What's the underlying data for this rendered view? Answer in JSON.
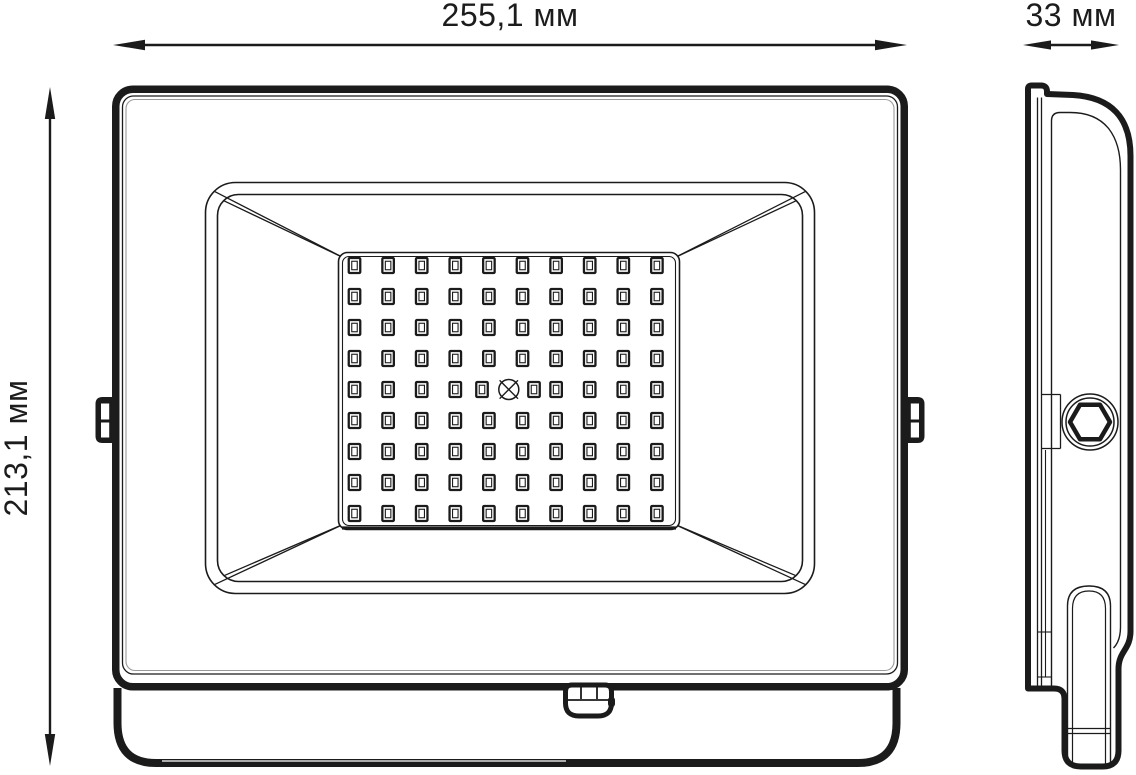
{
  "page": {
    "background": "#ffffff"
  },
  "drawing": {
    "type": "technical-dimension-drawing",
    "subject": "LED floodlight — front view and side view",
    "colors": {
      "line": "#1b1b1b",
      "highlight": "#9a9a9a",
      "background": "#ffffff"
    },
    "dimensions": {
      "width": {
        "label": "255,1 мм",
        "value_mm": 255.1,
        "orientation": "horizontal-top"
      },
      "depth": {
        "label": "33 мм",
        "value_mm": 33,
        "orientation": "horizontal-top-right"
      },
      "height": {
        "label": "213,1 мм",
        "value_mm": 213.1,
        "orientation": "vertical-left"
      }
    },
    "views": {
      "front": {
        "name": "front view",
        "features": [
          "housing",
          "bezel",
          "reflector",
          "led-panel",
          "side-mount-tabs",
          "cable-gland",
          "mounting-bracket"
        ]
      },
      "side": {
        "name": "side view",
        "features": [
          "profile",
          "hex-mount-knob",
          "mount-tab-edge",
          "bracket-arm"
        ]
      }
    },
    "led_grid": {
      "rows": 9,
      "cols": 10,
      "x0": 354.5,
      "y0": 265.5,
      "dx": 33.6,
      "dy": 31.0,
      "led_w": 11.5,
      "led_h": 15,
      "inner_w": 5.5,
      "inner_h": 8.5,
      "center_row_index": 4,
      "shifted_cols": {
        "4": 482,
        "5": 534
      },
      "crosshair": {
        "x": 508.8,
        "y": 389.5,
        "r": 10
      }
    }
  }
}
